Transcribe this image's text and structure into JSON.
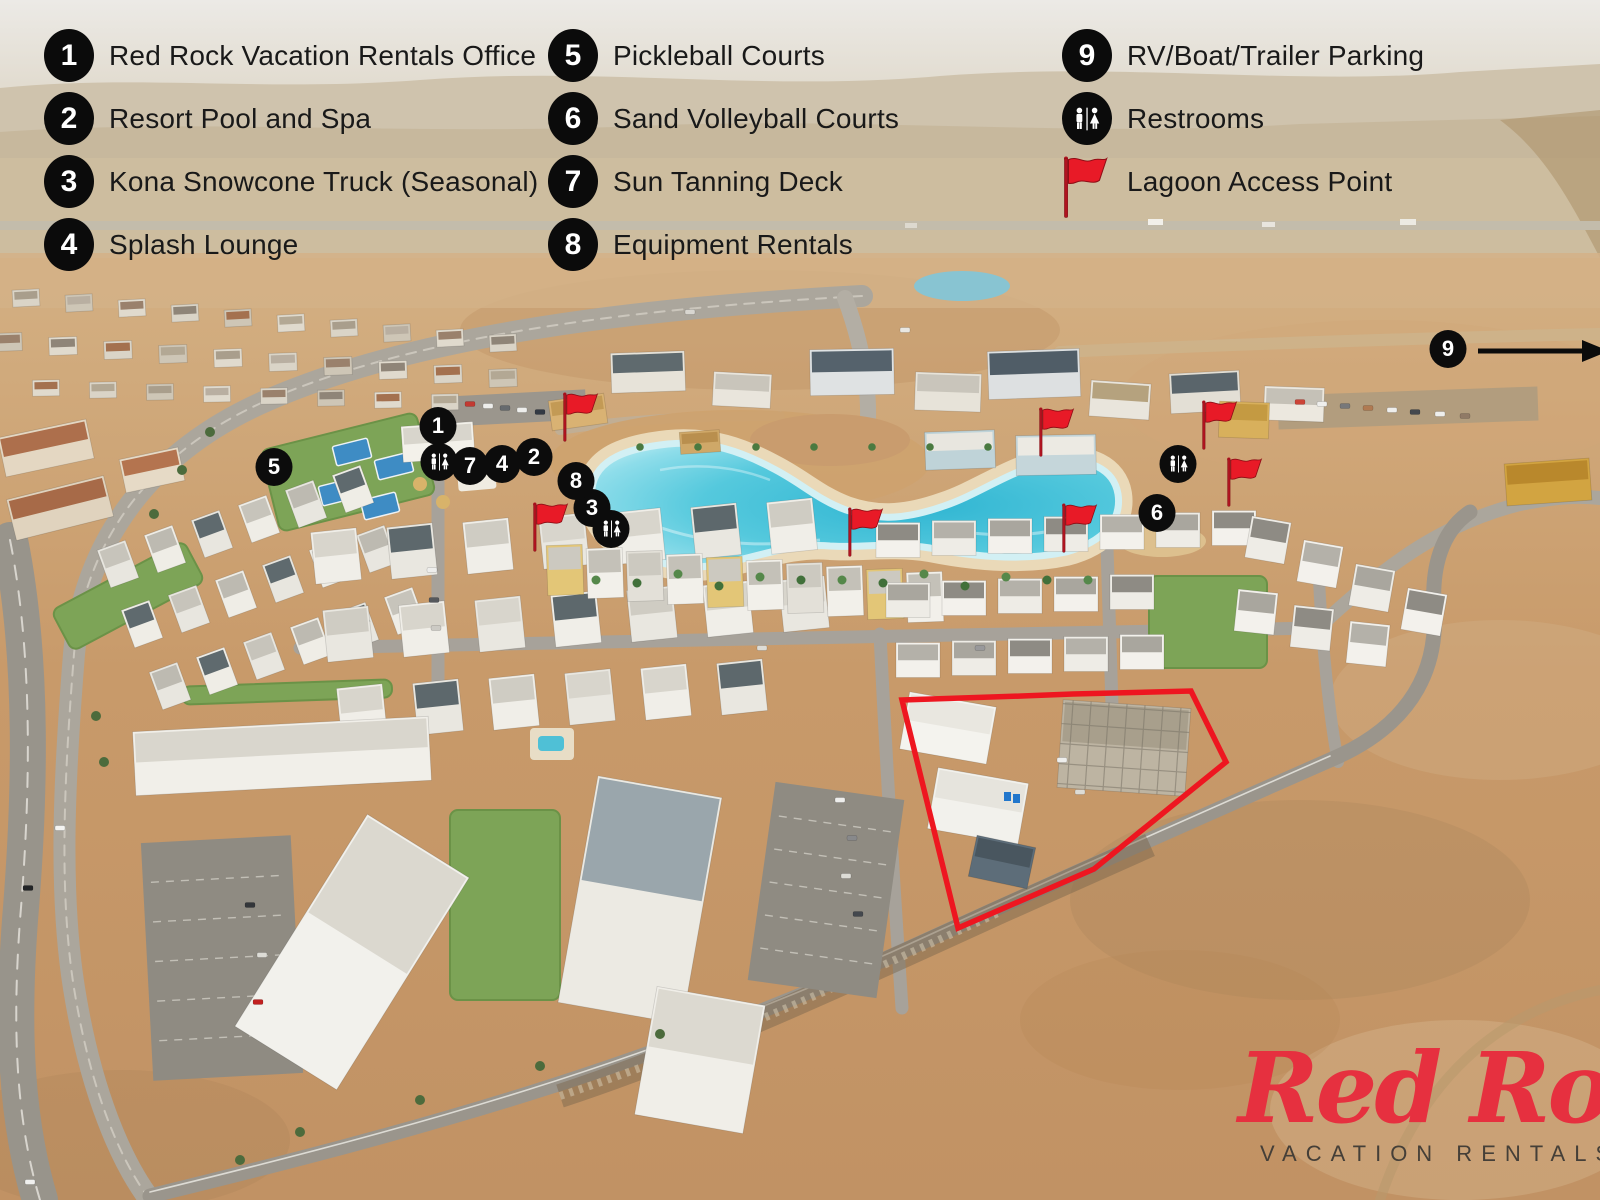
{
  "legend": {
    "columns": [
      {
        "items": [
          {
            "type": "number",
            "symbol": "1",
            "label": "Red Rock Vacation Rentals Office"
          },
          {
            "type": "number",
            "symbol": "2",
            "label": "Resort Pool and Spa"
          },
          {
            "type": "number",
            "symbol": "3",
            "label": "Kona Snowcone Truck (Seasonal)"
          },
          {
            "type": "number",
            "symbol": "4",
            "label": "Splash Lounge"
          }
        ]
      },
      {
        "items": [
          {
            "type": "number",
            "symbol": "5",
            "label": "Pickleball Courts"
          },
          {
            "type": "number",
            "symbol": "6",
            "label": "Sand Volleyball Courts"
          },
          {
            "type": "number",
            "symbol": "7",
            "label": "Sun Tanning Deck"
          },
          {
            "type": "number",
            "symbol": "8",
            "label": "Equipment Rentals"
          }
        ]
      },
      {
        "items": [
          {
            "type": "number",
            "symbol": "9",
            "label": "RV/Boat/Trailer Parking"
          },
          {
            "type": "restroom",
            "symbol": "restroom-icon",
            "label": "Restrooms"
          },
          {
            "type": "flag",
            "symbol": "red-flag-icon",
            "label": "Lagoon Access Point"
          }
        ]
      }
    ]
  },
  "map": {
    "number_markers": [
      {
        "symbol": "1",
        "x": 438,
        "y": 426
      },
      {
        "symbol": "2",
        "x": 534,
        "y": 457
      },
      {
        "symbol": "3",
        "x": 592,
        "y": 508
      },
      {
        "symbol": "4",
        "x": 502,
        "y": 464
      },
      {
        "symbol": "5",
        "x": 274,
        "y": 467
      },
      {
        "symbol": "6",
        "x": 1157,
        "y": 513
      },
      {
        "symbol": "7",
        "x": 470,
        "y": 466
      },
      {
        "symbol": "8",
        "x": 576,
        "y": 481
      },
      {
        "symbol": "9",
        "x": 1448,
        "y": 349,
        "arrow": "right"
      }
    ],
    "restroom_markers": [
      {
        "x": 439,
        "y": 462
      },
      {
        "x": 611,
        "y": 529
      },
      {
        "x": 1178,
        "y": 464
      }
    ],
    "flag_markers": [
      {
        "x": 565,
        "y": 442
      },
      {
        "x": 535,
        "y": 552
      },
      {
        "x": 850,
        "y": 557
      },
      {
        "x": 1041,
        "y": 457
      },
      {
        "x": 1204,
        "y": 450
      },
      {
        "x": 1229,
        "y": 507
      },
      {
        "x": 1064,
        "y": 553
      }
    ]
  },
  "logo": {
    "script": "Red Rock",
    "subtitle": "VACATION RENTALS"
  },
  "colors": {
    "marker_bg": "#0b0b0b",
    "marker_text": "#ffffff",
    "flag_red": "#e81a27",
    "flag_pole": "#b01420",
    "logo_red": "#e6303f",
    "legend_text": "#191919",
    "lagoon": "#3cbcd4",
    "boundary_red": "#ee1620"
  }
}
